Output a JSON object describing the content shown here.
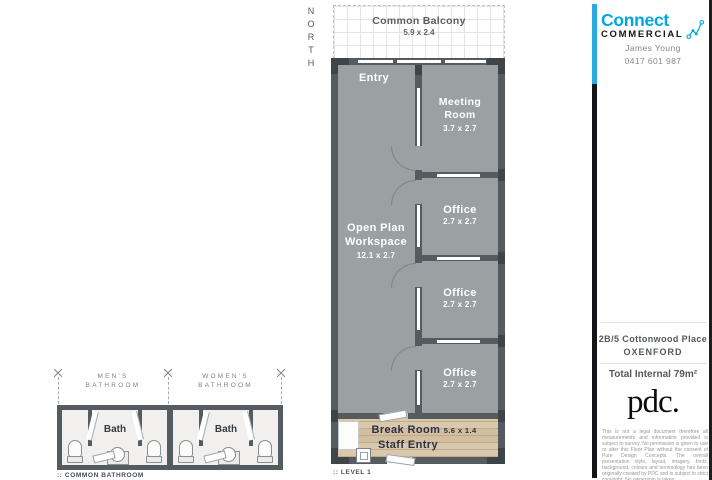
{
  "labels": {
    "north": "NORTH",
    "level": ":: LEVEL 1",
    "common_bathroom": ":: COMMON BATHROOM"
  },
  "balcony": {
    "name": "Common Balcony",
    "dims": "5.9 x 2.4"
  },
  "plan": {
    "entry": "Entry",
    "rooms": [
      {
        "name": "Meeting Room",
        "dims": "3.7 x 2.7"
      },
      {
        "name": "Office",
        "dims": "2.7 x 2.7"
      },
      {
        "name": "Office",
        "dims": "2.7 x 2.7"
      },
      {
        "name": "Office",
        "dims": "2.7 x 2.7"
      }
    ],
    "open_plan": {
      "name": "Open Plan Workspace",
      "dims": "12.1 x 2.7"
    },
    "break_room": {
      "name": "Break Room",
      "dims": "5.6 x 1.4",
      "staff_entry": "Staff Entry"
    }
  },
  "bathrooms": {
    "bath_label": "Bath",
    "mens": {
      "line1": "MEN'S",
      "line2": "BATHROOM"
    },
    "womens": {
      "line1": "WOMEN'S",
      "line2": "BATHROOM"
    }
  },
  "sidebar": {
    "brand": {
      "name": "Connect",
      "sub": "COMMERCIAL"
    },
    "agent": {
      "name": "James Young",
      "phone": "0417 601 987"
    },
    "address": {
      "line1": "2B/5 Cottonwood Place",
      "line2": "OXENFORD"
    },
    "total_internal": "Total Internal 79m²",
    "pdc": "pdc.",
    "disclaimer": "This is not a legal document therefore all measurements and information provided is subject to survey. No permission is given to use or alter this Floor Plan without the consent of Pure Design Concepts. The overall presentation style, layout, imagery, fonts, background, colours and terminology has been originally created by PDC and is subject to strict copyright. No ownership is taken."
  },
  "colors": {
    "wall": "#565b5f",
    "floor": "#9ba0a3",
    "wood": "#d8c6a9",
    "divider_blue": "#29abe2",
    "logo_blue": "#00a7e1",
    "break_text_navy": "#2b3145"
  }
}
